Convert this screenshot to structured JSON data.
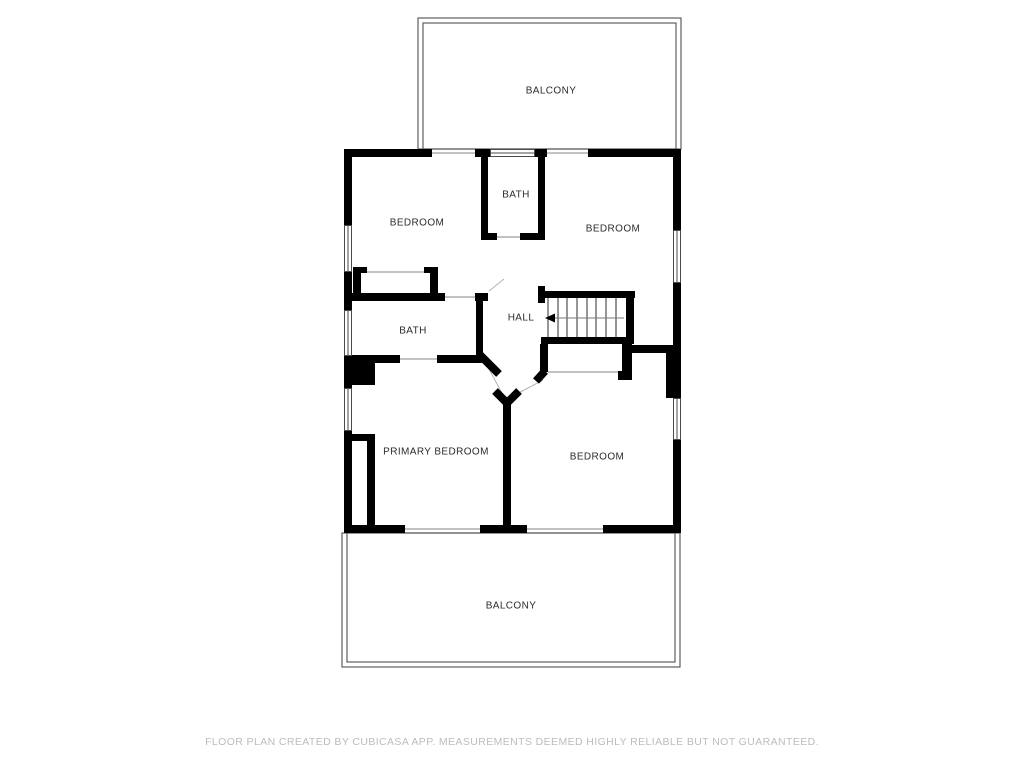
{
  "floor_plan": {
    "rooms": {
      "balcony_top": {
        "label": "BALCONY"
      },
      "bedroom_top_left": {
        "label": "BEDROOM"
      },
      "bath_top": {
        "label": "BATH"
      },
      "bedroom_top_right": {
        "label": "BEDROOM"
      },
      "bath_middle": {
        "label": "BATH"
      },
      "hall": {
        "label": "HALL"
      },
      "primary_bedroom": {
        "label": "PRIMARY BEDROOM"
      },
      "bedroom_bottom_right": {
        "label": "BEDROOM"
      },
      "balcony_bottom": {
        "label": "BALCONY"
      }
    },
    "stairs": {
      "arrow_direction": "left"
    },
    "colors": {
      "wall": "#000000",
      "background": "#ffffff",
      "room_label": "#2b2b2b",
      "balcony_outline": "#5f5f5f",
      "threshold_line": "#9d9d9d",
      "stair_tread_line": "#2e2e2e",
      "disclaimer_text": "#bcbcbc"
    }
  },
  "footer": {
    "disclaimer": "FLOOR PLAN CREATED BY CUBICASA APP. MEASUREMENTS DEEMED HIGHLY RELIABLE BUT NOT GUARANTEED."
  }
}
